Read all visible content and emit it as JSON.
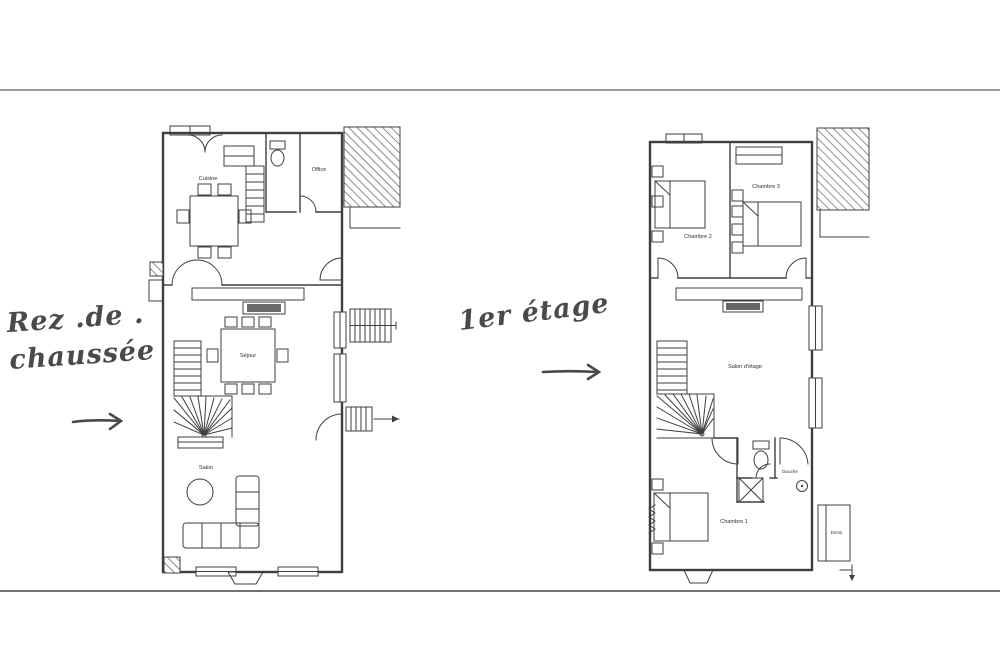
{
  "colors": {
    "paper": "#ffffff",
    "top_rule": "#98a098",
    "bottom_rule": "#6e746e",
    "handwriting_ink": "#4a4a4a",
    "plan_line": "#3f3f3f"
  },
  "annotations": {
    "ground_floor_label_line1": "Rez .de .",
    "ground_floor_label_line2": "chaussée",
    "ground_floor_arrow_icon": "right-arrow",
    "first_floor_label": "1er étage",
    "first_floor_arrow_icon": "right-arrow"
  },
  "ground_floor": {
    "rooms": {
      "cuisine": "Cuisine",
      "office": "Office",
      "sejour": "Séjour",
      "salon": "Salon"
    }
  },
  "first_floor": {
    "rooms": {
      "chambre1": "Chambre 1",
      "chambre2": "Chambre 2",
      "chambre3": "Chambre 3",
      "salon_etage": "Salon d'étage",
      "douche": "Douche",
      "dressing": "Dress."
    }
  }
}
